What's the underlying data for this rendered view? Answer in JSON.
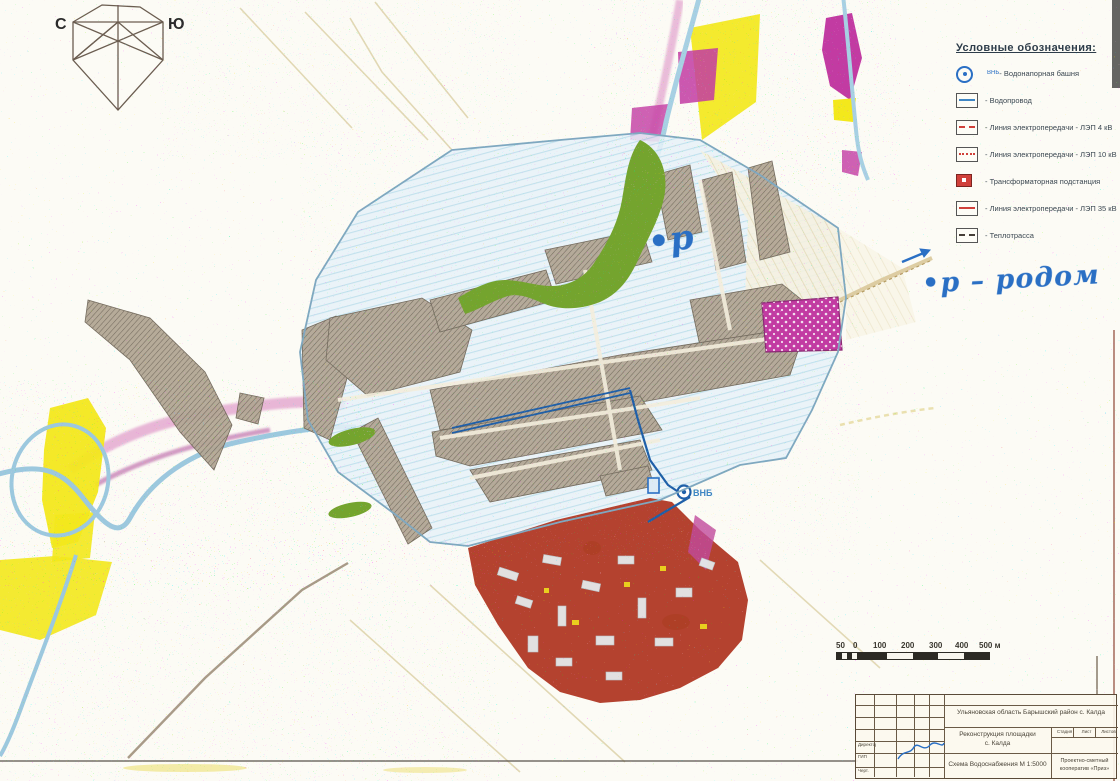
{
  "compass": {
    "north_label": "С",
    "south_label": "Ю"
  },
  "legend": {
    "title": "Условные обозначения:",
    "items": [
      {
        "name": "water-tower",
        "label": "- Водонапорная башня",
        "badge": "ВНБ"
      },
      {
        "name": "water-line",
        "label": "- Водопровод"
      },
      {
        "name": "power-line-4kv",
        "label": "- Линия электропередачи - ЛЭП 4 кВ"
      },
      {
        "name": "power-line-10kv",
        "label": "- Линия электропередачи - ЛЭП 10 кВ"
      },
      {
        "name": "transformer-substation",
        "label": "- Трансформаторная подстанция"
      },
      {
        "name": "power-line-35kv",
        "label": "- Линия электропередачи - ЛЭП 35 кВ"
      },
      {
        "name": "heat-main",
        "label": "- Теплотрасса"
      }
    ]
  },
  "map_labels": {
    "water_tower": "ВНБ"
  },
  "annotations": {
    "right_note": "•р – родом",
    "map_note": "•р"
  },
  "scale_bar": {
    "labels": [
      "50",
      "0",
      "100",
      "200",
      "300",
      "400",
      "500 м"
    ]
  },
  "title_block": {
    "location": "Ульяновская область Барышский район с. Калда",
    "project_line1": "Реконструкция площадки",
    "project_line2": "с. Калда",
    "drawing_name": "Схема Водоснабжения М 1:5000",
    "stage_headers": [
      "Стадия",
      "Лист",
      "Листов"
    ],
    "org_line1": "Проектно-сметный",
    "org_line2": "кооператив «Приз»",
    "sign_roles": [
      "Директор",
      "ГИП",
      "Черт."
    ]
  },
  "colors": {
    "paper": "#fcfbf5",
    "fields_blue": "#cfe7f2",
    "urban_hatch": "#b3a795",
    "park_green": "#74a42e",
    "industrial_red": "#b13a26",
    "meadow_yellow": "#f3e81c",
    "wetland_magenta": "#c23ba2",
    "river_blue": "#9cc8de",
    "pipeline_blue": "#1f5fa8",
    "ink_blue": "#2a6fc4",
    "road_tan": "#d9c89a"
  }
}
